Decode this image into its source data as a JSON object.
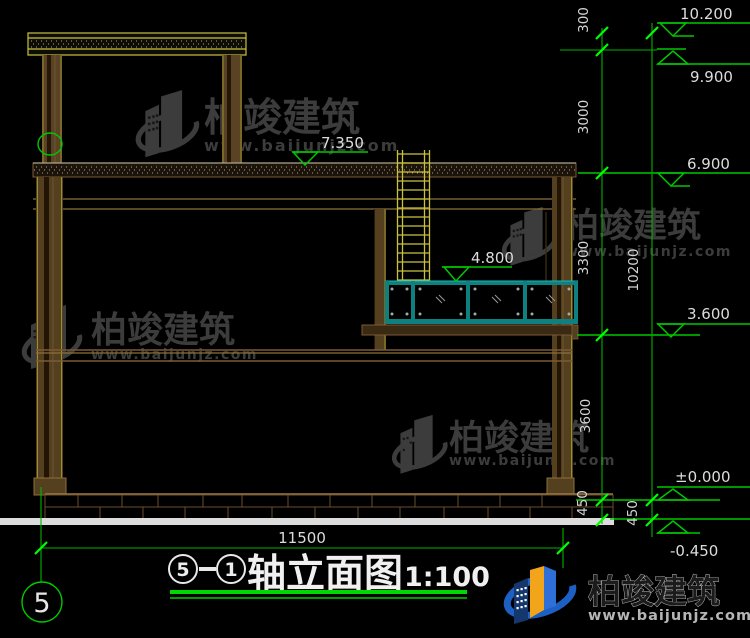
{
  "brand": {
    "name": "柏竣建筑",
    "site": "www.baijunjz.com"
  },
  "levels": {
    "roof_top": "10.200",
    "roof": "9.900",
    "canopy": "7.350",
    "main_roof": "6.900",
    "railing_top": "4.800",
    "terrace": "3.600",
    "ground": "±0.000",
    "site_gl": "-0.450"
  },
  "dims": {
    "seg300": "300",
    "seg3000": "3000",
    "seg3300": "3300",
    "seg3600": "3600",
    "seg450_inner": "450",
    "total_height": "10200",
    "seg450_outer": "450",
    "total_width": "11500"
  },
  "axis_bubble": "5",
  "title": {
    "axis_from": "5",
    "axis_to": "1",
    "name": "轴立面图",
    "scale": "1:100"
  }
}
